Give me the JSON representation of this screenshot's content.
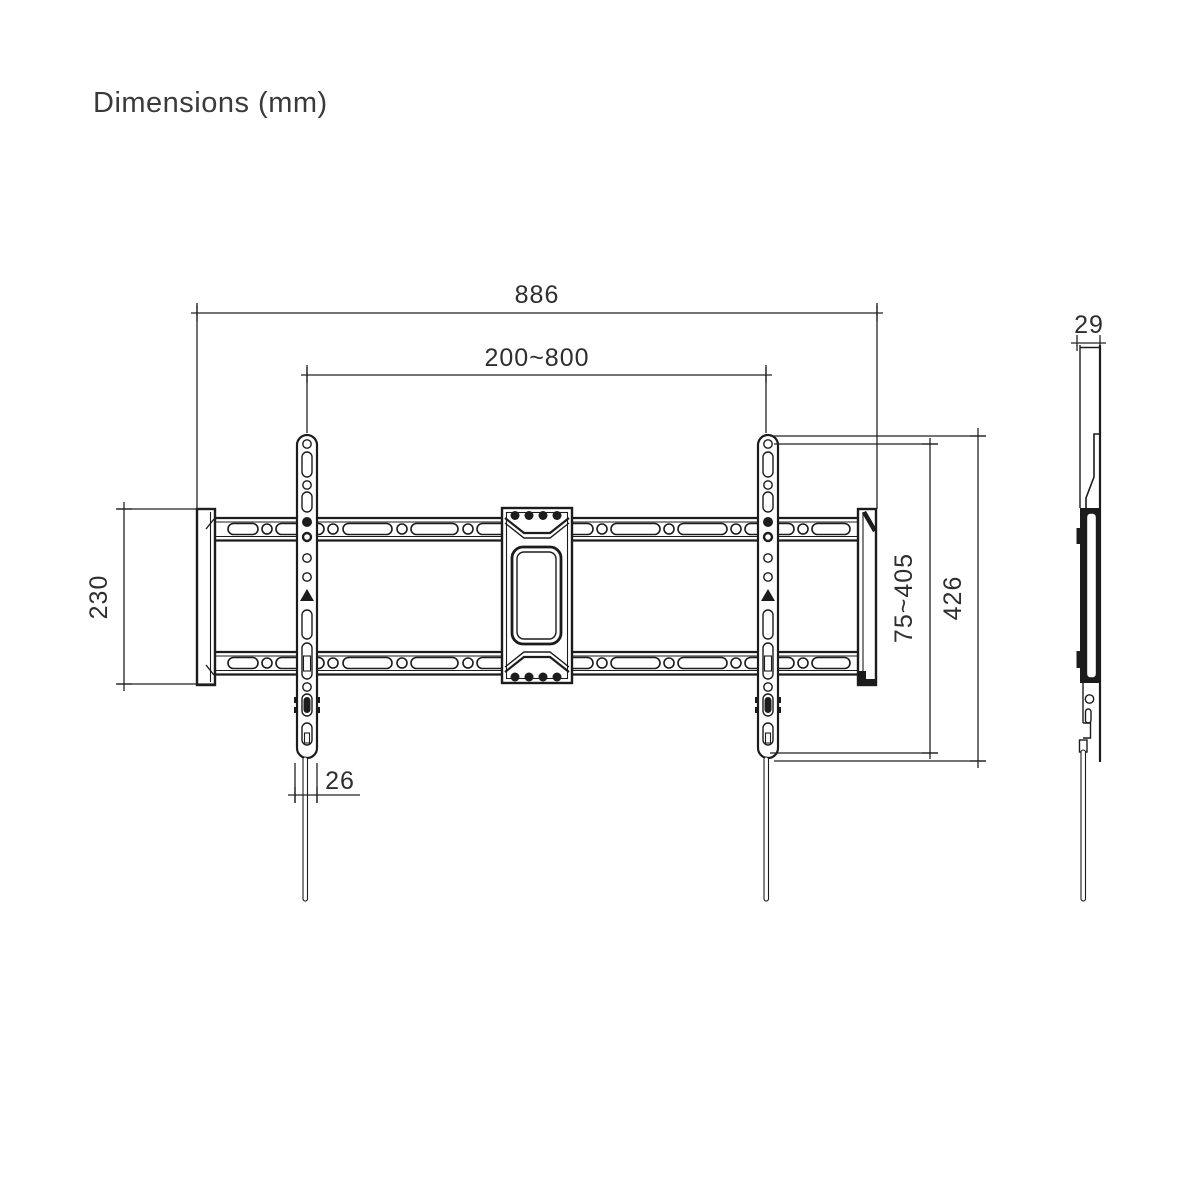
{
  "title": "Dimensions (mm)",
  "front_view": {
    "total_width": "886",
    "vesa_width_range": "200~800",
    "wall_plate_height": "230",
    "vesa_height_range": "75~405",
    "bracket_height": "426",
    "bracket_width": "26"
  },
  "side_view": {
    "depth": "29"
  },
  "colors": {
    "line": "#1c1c1c",
    "dimension_text": "#2e2e2e",
    "title_text": "#3a3a3a",
    "background": "#ffffff"
  }
}
